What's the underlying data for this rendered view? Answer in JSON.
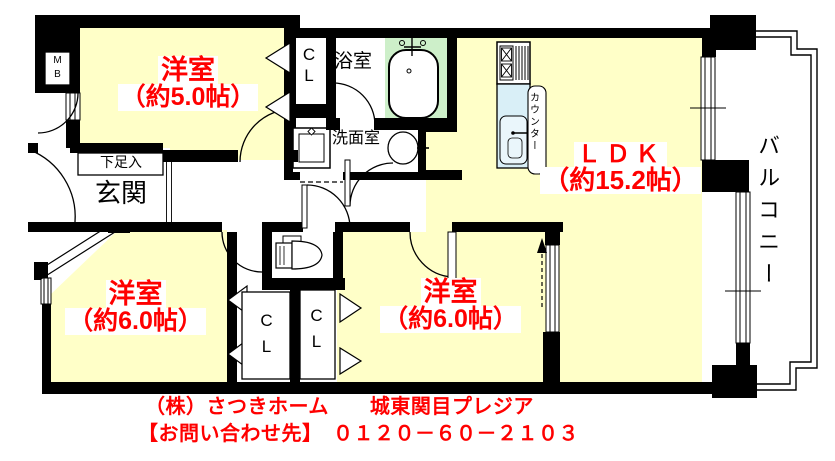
{
  "plan": {
    "rooms": {
      "western1": {
        "name": "洋室",
        "size": "（約5.0帖）"
      },
      "western2": {
        "name": "洋室",
        "size": "（約6.0帖）"
      },
      "western3": {
        "name": "洋室",
        "size": "（約6.0帖）"
      },
      "ldk": {
        "name": "ＬＤＫ",
        "size": "（約15.2帖）"
      }
    },
    "labels": {
      "balcony": "バルコニー",
      "bathroom": "浴室",
      "washroom": "洗面室",
      "entrance": "玄関",
      "shoe_box": "下足入",
      "counter": "カウンター",
      "meter_box": {
        "line1": "M",
        "line2": "B"
      },
      "closet": {
        "line1": "C",
        "line2": "L"
      }
    }
  },
  "footer": {
    "company_property": "（株）さつきホーム　　城東関目プレジア",
    "contact": "【お問い合わせ先】　０１２０－６０－２１０３"
  },
  "colors": {
    "room_fill": "#FFFFC8",
    "bath_fill": "#CDEFC9",
    "kitchen_fill": "#D9EFF7",
    "sink_fill": "#EAF6FB",
    "label_red": "#FF0000",
    "wall_black": "#000000"
  }
}
